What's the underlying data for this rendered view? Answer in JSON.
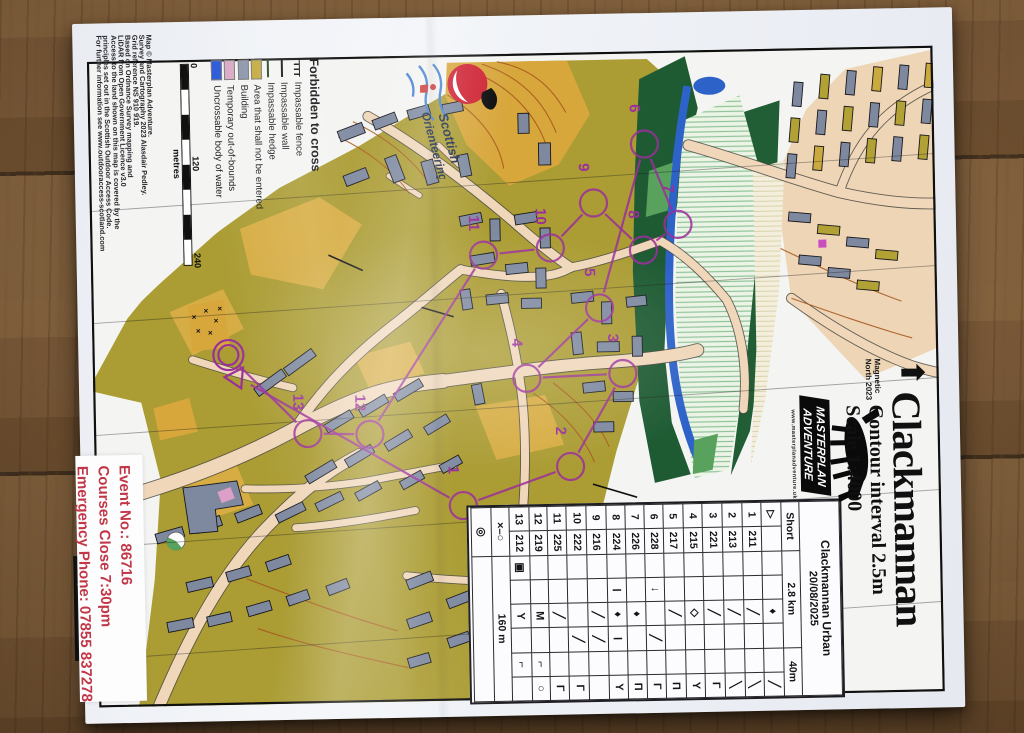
{
  "accent_colors": {
    "course_purple": "#9b2f9b",
    "event_red": "#c23747",
    "map_olive": "#ab9c33",
    "map_yellow": "#d9ae45",
    "building_grey": "#7e89a0",
    "water_blue": "#2d62c9"
  },
  "title_block": {
    "title": "Clackmannan",
    "subtitle_contour": "Contour interval 2.5m",
    "subtitle_scale": "Scale 1:4000",
    "north_arrow_glyph": "⬆",
    "magnetic_line1": "Magnetic",
    "magnetic_line2": "North 2023"
  },
  "legend": {
    "heading": "Forbidden to cross",
    "items": [
      {
        "label": "Impassable fence",
        "kind": "fence",
        "icon": "fence-line-icon"
      },
      {
        "label": "Impassable wall",
        "kind": "wall",
        "icon": "wall-line-icon"
      },
      {
        "label": "Impassable hedge",
        "kind": "hedge",
        "icon": "hedge-line-icon"
      },
      {
        "label": "Area that shall not be entered",
        "kind": "swatch",
        "color": "#c3a93a",
        "icon": "area-swatch-icon"
      },
      {
        "label": "Building",
        "kind": "swatch",
        "color": "#8a94a8",
        "icon": "building-swatch-icon"
      },
      {
        "label": "Temporary out-of-bounds",
        "kind": "swatch",
        "color": "#d9a8c6",
        "icon": "oob-swatch-icon"
      },
      {
        "label": "Uncrossable body of water",
        "kind": "swatch",
        "color": "#2756d8",
        "icon": "water-swatch-icon"
      }
    ]
  },
  "scale_bar": {
    "labels": [
      "0",
      "120",
      "240"
    ],
    "unit": "metres"
  },
  "credits": {
    "lines": [
      "Map © Masterplan Adventure.",
      "Survey and Cartography 2023 Alasdair Pedley.",
      "Grid reference NS 910 919.",
      "Based on Ordnance Survey mapping and",
      "LiDAR from Open Government Licence v3.0",
      "Access to the land shown on this map is covered by the",
      "principles set out in the Scottish Outdoor Access Code.",
      "For further information see www.outdooraccess-scotland.com"
    ]
  },
  "symbols_note": "ISSprOM 2019-2",
  "event_info": {
    "lines": [
      "Event No.: 86716",
      "Courses Close 7:30pm",
      "Emergency Phone: 07855 837278"
    ]
  },
  "logos": {
    "scottish": {
      "line1": "Scottish",
      "line2": "Orienteering"
    },
    "masterplan": {
      "line1": "MASTERPLAN",
      "line2": "ADVENTURE",
      "website": "www.masterplanadventure.uk"
    }
  },
  "control_card": {
    "event_name": "Clackmannan Urban",
    "event_date": "20/08/2025",
    "course_row": [
      "Short",
      "2.8 km",
      "40m"
    ],
    "start_row": {
      "no": "▷",
      "code": "",
      "sym": [
        "",
        "",
        "♦",
        "",
        "",
        "╱"
      ]
    },
    "rows": [
      {
        "no": "1",
        "code": "211",
        "sym": [
          "",
          "",
          "╱",
          "",
          "",
          "╲"
        ]
      },
      {
        "no": "2",
        "code": "213",
        "sym": [
          "",
          "",
          "╱",
          "",
          "",
          "╲"
        ]
      },
      {
        "no": "3",
        "code": "221",
        "sym": [
          "",
          "",
          "╱",
          "",
          "",
          "Γ"
        ]
      },
      {
        "no": "4",
        "code": "215",
        "sym": [
          "",
          "",
          "◇",
          "",
          "",
          "Y"
        ]
      },
      {
        "no": "5",
        "code": "217",
        "sym": [
          "",
          "",
          "╱",
          "",
          "",
          "Π"
        ]
      },
      {
        "no": "6",
        "code": "228",
        "sym": [
          "",
          "↓",
          "",
          "╱",
          "",
          "Γ"
        ]
      },
      {
        "no": "7",
        "code": "226",
        "sym": [
          "",
          "",
          "♦",
          "",
          "",
          "Π"
        ]
      },
      {
        "no": "8",
        "code": "224",
        "sym": [
          "",
          "Ⅰ",
          "♦",
          "Ⅰ",
          "",
          "Y"
        ]
      },
      {
        "no": "9",
        "code": "216",
        "sym": [
          "",
          "",
          "╱",
          "╱",
          "",
          ""
        ]
      },
      {
        "no": "10",
        "code": "222",
        "sym": [
          "",
          "",
          "",
          "╱",
          "",
          "Γ"
        ]
      },
      {
        "no": "11",
        "code": "225",
        "sym": [
          "",
          "",
          "╱",
          "",
          "",
          "Γ"
        ]
      },
      {
        "no": "12",
        "code": "219",
        "sym": [
          "",
          "",
          "M",
          "",
          "⌐",
          "○"
        ]
      },
      {
        "no": "13",
        "code": "212",
        "sym": [
          "▣",
          "",
          "Y",
          "",
          "⌐",
          ""
        ]
      }
    ],
    "finish_route": {
      "sym": "×–○",
      "dist": "160 m"
    },
    "finish_sym": "◎"
  },
  "course": {
    "color": "#9b2f9b",
    "start": {
      "x": 144,
      "y": 318
    },
    "finish": {
      "x": 136,
      "y": 296
    },
    "controls": [
      {
        "n": "1",
        "x": 368,
        "y": 451
      },
      {
        "n": "2",
        "x": 476,
        "y": 414
      },
      {
        "n": "3",
        "x": 530,
        "y": 322
      },
      {
        "n": "4",
        "x": 434,
        "y": 325
      },
      {
        "n": "5",
        "x": 508,
        "y": 256
      },
      {
        "n": "6",
        "x": 556,
        "y": 93
      },
      {
        "n": "7",
        "x": 588,
        "y": 174
      },
      {
        "n": "8",
        "x": 553,
        "y": 199
      },
      {
        "n": "9",
        "x": 504,
        "y": 151
      },
      {
        "n": "10",
        "x": 460,
        "y": 195
      },
      {
        "n": "11",
        "x": 393,
        "y": 201
      },
      {
        "n": "12",
        "x": 276,
        "y": 378
      },
      {
        "n": "13",
        "x": 214,
        "y": 376
      }
    ]
  }
}
